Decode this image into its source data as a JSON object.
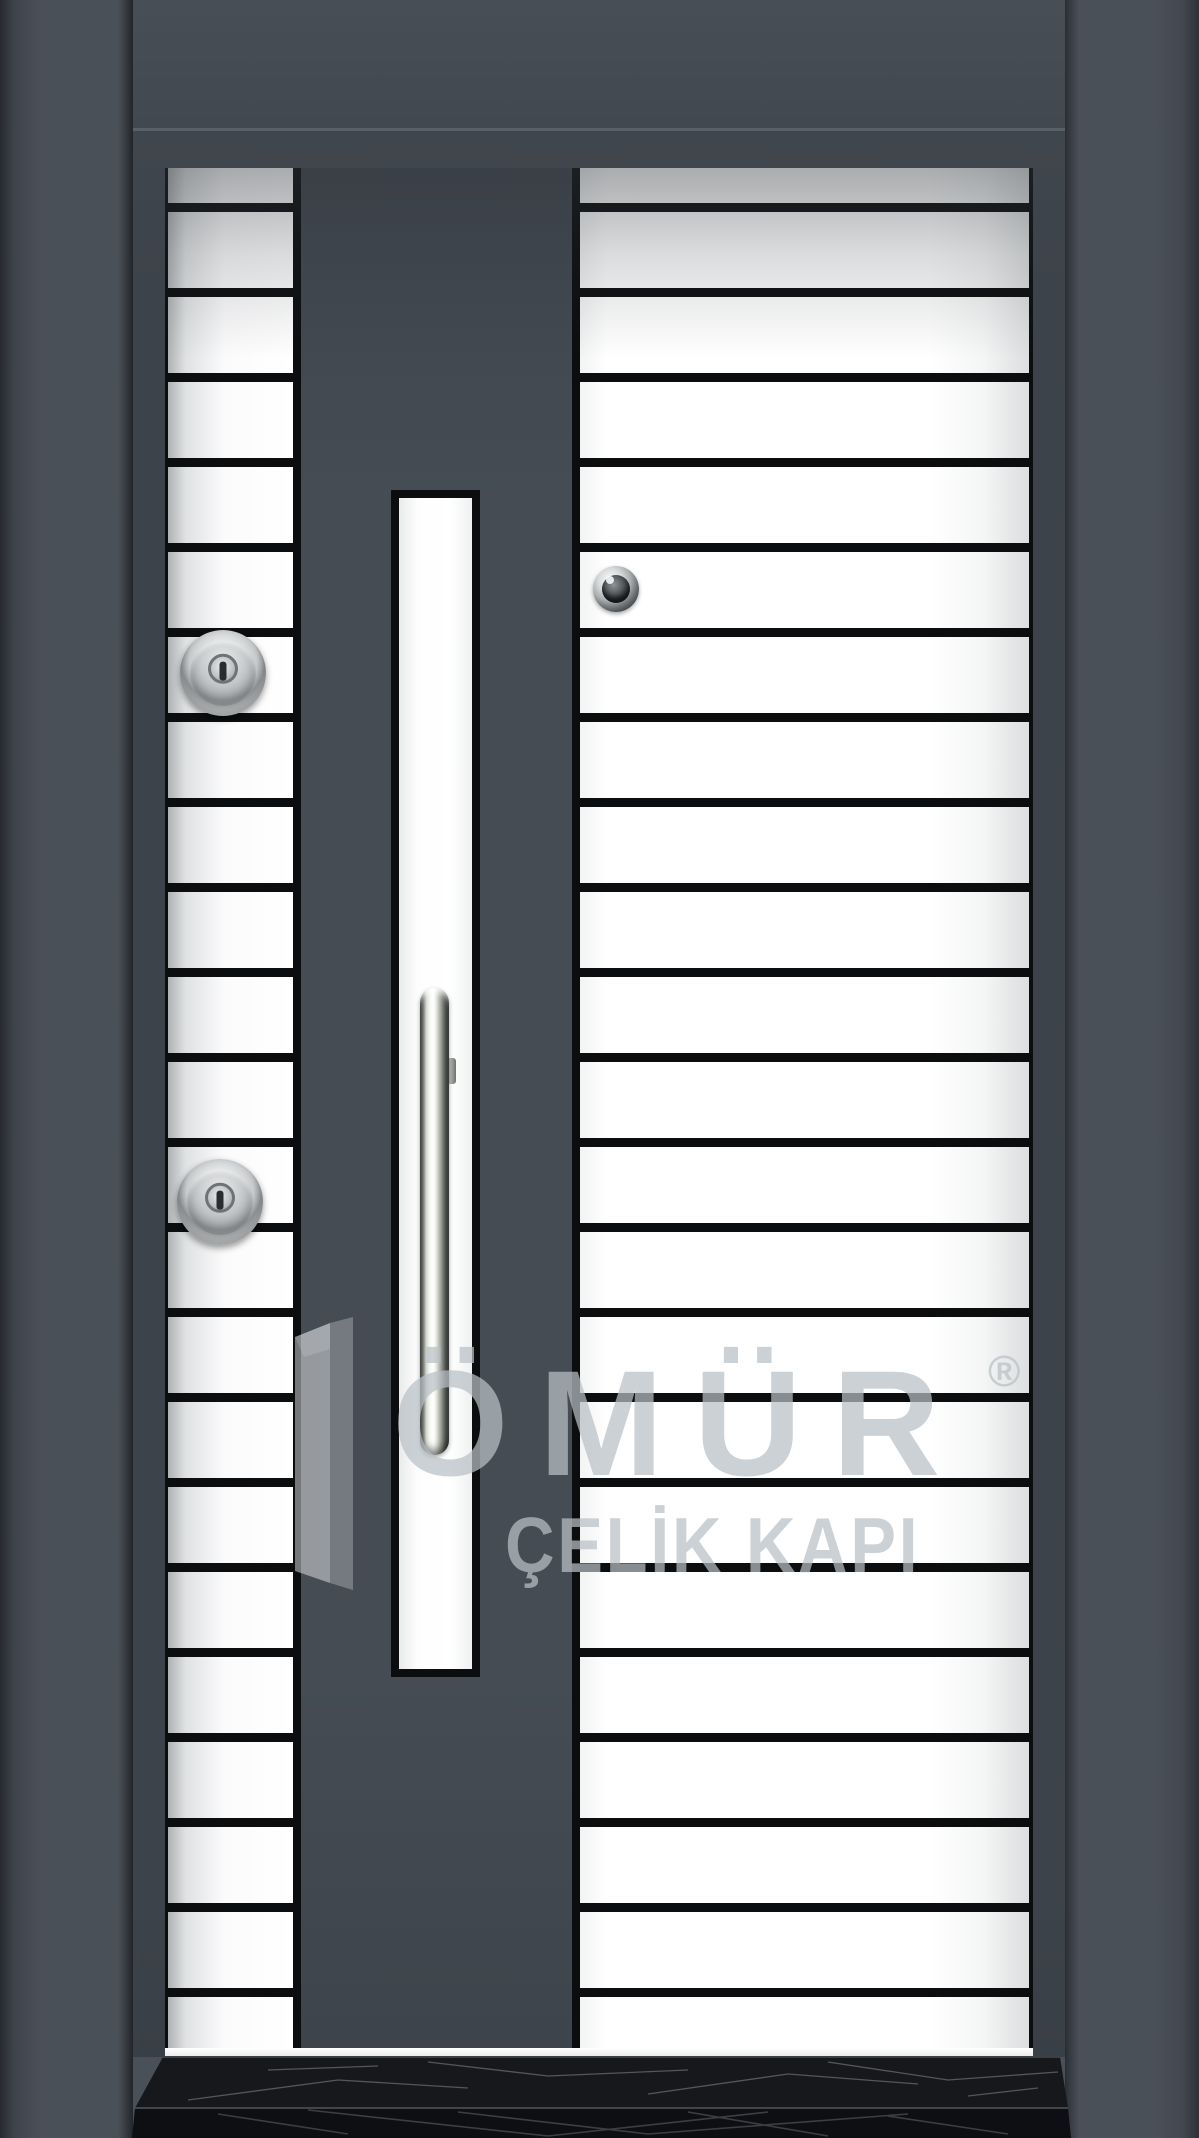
{
  "scene": {
    "description": "steel security door product photo",
    "wall_color": "#4a5058",
    "transom_color": "#454b53",
    "frame_color": "#3d434a",
    "center_band_color": "#434a52",
    "leaf_color": "#ffffff",
    "groove_color": "#0b0d0f",
    "marble_color": "#131417",
    "chrome_color": "#d7dad2"
  },
  "door": {
    "stripe_pitch": 85,
    "stripe_line_thickness": 9,
    "first_line_offset": 35,
    "line_count": 22,
    "columns": [
      {
        "name": "left-stripe-column"
      },
      {
        "name": "right-stripe-column"
      }
    ],
    "hardware": [
      {
        "icon": "peephole-icon"
      },
      {
        "icon": "lock-cylinder-icon",
        "position": "upper"
      },
      {
        "icon": "lock-cylinder-icon",
        "position": "lower"
      },
      {
        "icon": "pull-handle-icon"
      },
      {
        "icon": "glass-strip"
      }
    ]
  },
  "watermark": {
    "logo_icon": "open-door-logo-icon",
    "brand": "ÖMÜR",
    "registered": "®",
    "subtitle": "ÇELİK KAPI"
  }
}
